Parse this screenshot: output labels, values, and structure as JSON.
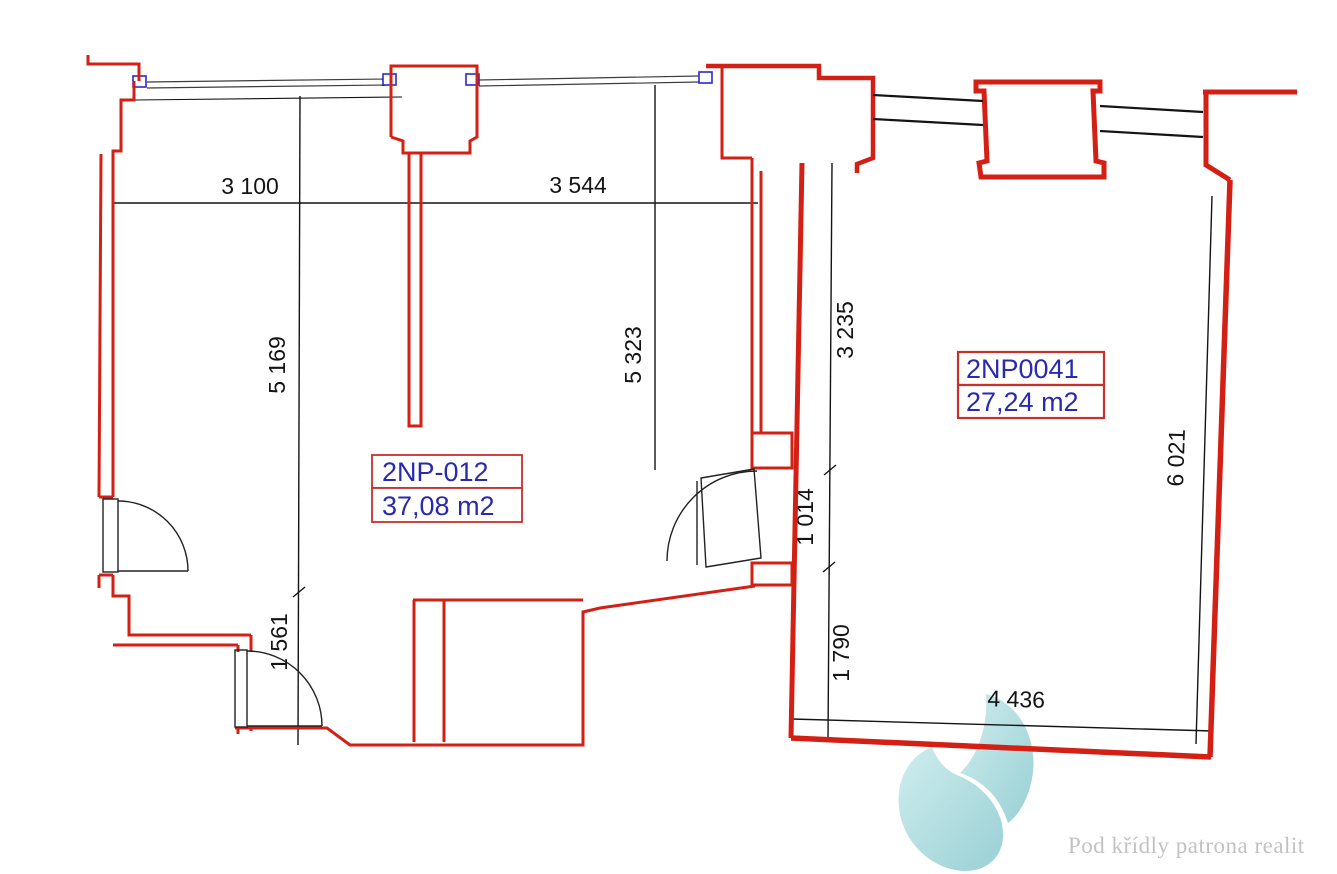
{
  "rooms": [
    {
      "code": "2NP-012",
      "area": "37,08 m2"
    },
    {
      "code": "2NP0041",
      "area": "27,24 m2"
    }
  ],
  "dimensions": {
    "left_width_a": "3 100",
    "left_width_b": "3 544",
    "left_height_a": "5 169",
    "left_height_b": "5 323",
    "left_lower_height": "1 561",
    "right_upper_height": "3 235",
    "right_mid_height": "1 014",
    "right_lower_height": "1 790",
    "right_side_height": "6 021",
    "right_bottom_width": "4 436"
  },
  "watermark": {
    "tagline": "Pod křídly patrona realit",
    "logo_color": "#a9d8da",
    "text_color": "#c3c2c1"
  },
  "colors": {
    "wall_red": "#d42014",
    "label_blue": "#2a2ab0",
    "dimension_black": "#141414",
    "window_blue": "#2a2ad0"
  }
}
